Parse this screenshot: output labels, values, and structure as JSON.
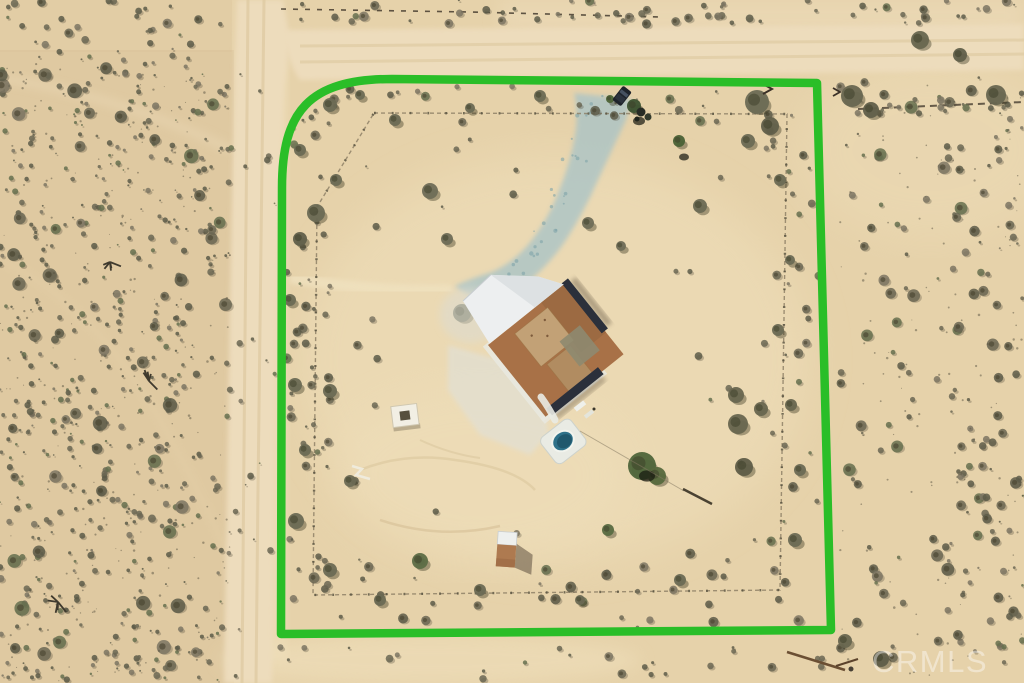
{
  "meta": {
    "type": "aerial-photograph",
    "subject": "Top-down drone photo of a fenced desert parcel with a house, pool-spa, shed and dirt roads; parcel outlined in green",
    "setting": "desert scrub"
  },
  "watermark": {
    "text": "CRMLS"
  },
  "boundary": {
    "color": "#2abe28",
    "stroke_width": 8.5,
    "description": "bright green parcel outline, rounded top-left corner"
  },
  "palette": {
    "sand_base": "#e6d2aa",
    "sand_light": "#f0e0bc",
    "sand_scrub": "#d6bf96",
    "road": "#eddcbc",
    "road_track": "#decaa2",
    "bush_dark": "#5d5c49",
    "bush_mid": "#6b6753",
    "bush_pale": "#7c7663",
    "bush_green": "#66704f",
    "bush_shadow": "#4e4938",
    "tree_green_dark": "#49593a",
    "roof_brown": "#a87147",
    "roof_brown_dark": "#9c6a42",
    "roof_tan": "#c2a176",
    "roof_tan_dark": "#b18c61",
    "roof_olive": "#8e8a70",
    "roof_ridge": "#2b303b",
    "roof_white": "#edeff0",
    "roof_white_shade": "#dde1e3",
    "eave_white": "#e9e9e1",
    "apron": "#e1e0d5",
    "gravel": "#abc4c6",
    "gravel_dot": "#7fa3a8",
    "pool_deck": "#e9ebe4",
    "pool_water": "#2e7189",
    "pool_water_dark": "#1d5468",
    "shed_roof": "#eef0ee",
    "shed_body": "#ae7a50",
    "shadow_dark": "#4f4233",
    "fence_line": "#8a7c63",
    "fence_post": "#55503f",
    "outer_fence": "#453c2f",
    "stick_brown": "#6b4f33",
    "vehicle_dark": "#1f242b"
  }
}
